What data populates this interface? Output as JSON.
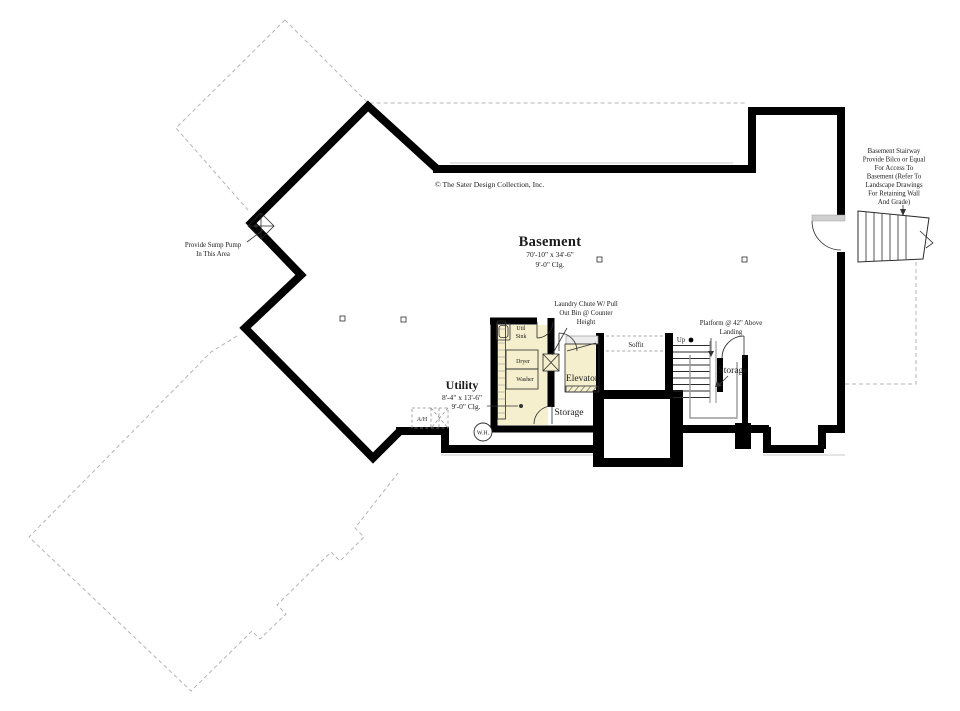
{
  "drawing": {
    "copyright": "© The Sater Design Collection, Inc.",
    "rooms": {
      "basement": {
        "name": "Basement",
        "dims": "70'-10\" x 34'-6\"",
        "ceiling": "9'-0\" Clg."
      },
      "utility": {
        "name": "Utility",
        "dims": "8'-4\" x 13'-6\"",
        "ceiling": "9'-0\" Clg."
      },
      "elevator": {
        "name": "Elevator"
      },
      "storage_lobby": {
        "name": "Storage"
      },
      "storage_under_stair": {
        "name": "Storage"
      },
      "soffit": {
        "name": "Soffit"
      }
    },
    "fixtures": {
      "util_sink_line1": "Util",
      "util_sink_line2": "Sink",
      "dryer": "Dryer",
      "washer": "Washer",
      "water_heater": "W.H.",
      "air_handler": "A/H",
      "up": "Up"
    },
    "notes": {
      "sump": {
        "lines": [
          "Provide Sump Pump",
          "In This Area"
        ]
      },
      "stairway": {
        "lines": [
          "Basement Stairway",
          "Provide Bilco or Equal",
          "For Access To",
          "Basement (Refer To",
          "Landscape Drawings",
          "For Retaining Wall",
          "And Grade)"
        ]
      },
      "laundry": {
        "lines": [
          "Laundry Chute W/ Pull",
          "Out Bin @ Counter",
          "Height"
        ]
      },
      "platform": {
        "lines": [
          "Platform @ 42\" Above",
          "Landing"
        ]
      }
    },
    "colors": {
      "walls": "#000000",
      "room_fill": "#f5efce",
      "grey_line": "#9a9a9a",
      "dashed_outline": "#b5b5b5"
    }
  }
}
